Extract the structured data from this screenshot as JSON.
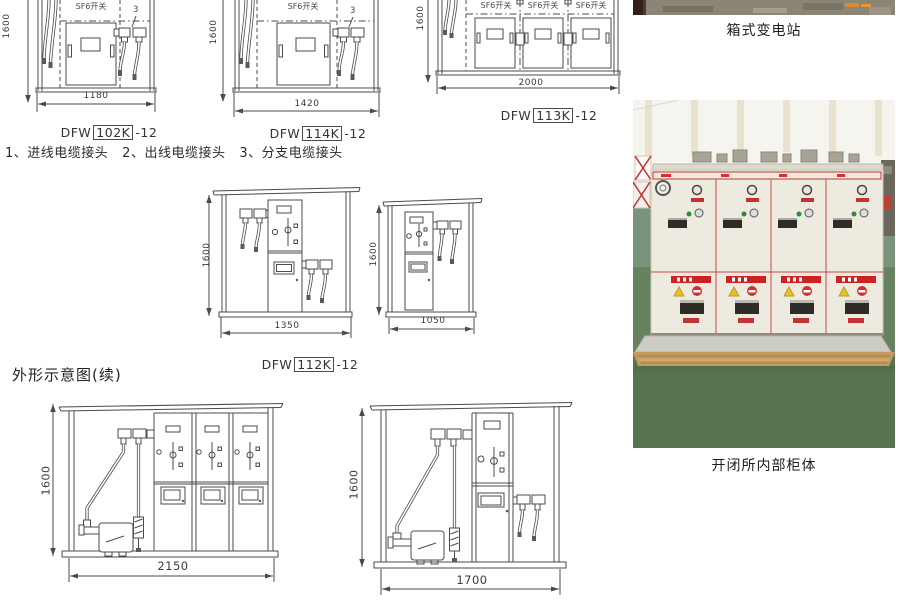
{
  "note": "1、进线电缆接头   2、出线电缆接头   3、分支电缆接头",
  "section_title": "外形示意图(续)",
  "sf6_label": "SF6开关",
  "callout3": "3",
  "models": {
    "prefix": "DFW",
    "suffix": "-12",
    "a_box": "102K",
    "b_box": "114K",
    "c_box": "113K",
    "d_box": "112K"
  },
  "dims": {
    "h": "1600",
    "a_w": "1180",
    "b_w": "1420",
    "c_w": "2000",
    "d_w": "1350",
    "e_w": "1050",
    "f_w": "2150",
    "g_w": "1700"
  },
  "photos": {
    "top_caption": "箱式变电站",
    "bottom_caption": "开闭所内部柜体"
  },
  "colors": {
    "line": "#4b4b4b",
    "accent_red": "#cc2a2a",
    "floor_green": "#66825f",
    "cabinet_beige": "#edebdf",
    "wood_tan": "#c39a5f",
    "watermark_orange": "#e08a2c"
  }
}
